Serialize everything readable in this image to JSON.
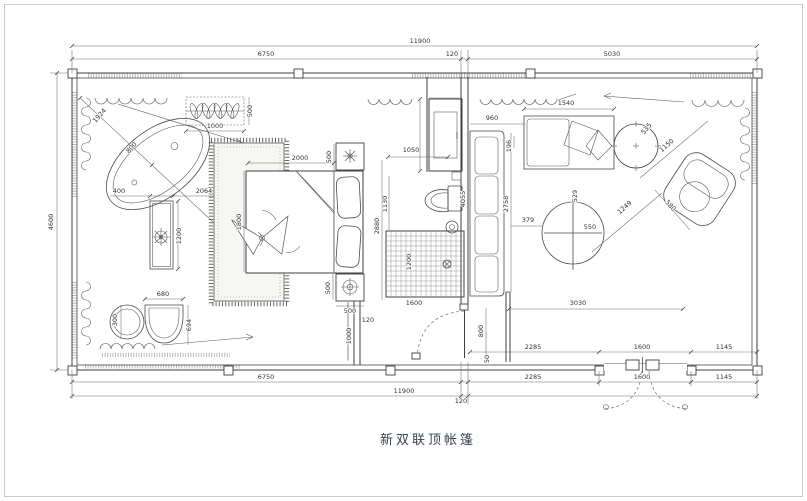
{
  "caption": {
    "text": "新双联顶帐篷"
  },
  "colors": {
    "line": "#3f3f3f",
    "dim_text": "#323232",
    "caption_text": "#39414f",
    "frame_border": "#c9c9c9",
    "background": "#ffffff",
    "shower_grid": "#8a8a8a"
  },
  "elements": {
    "left_zone": [
      "bathtub",
      "plant-rack",
      "vanity-table",
      "round-stool",
      "tub-chair",
      "double-bed",
      "bed-carpet",
      "nightstand-top",
      "nightstand-bottom",
      "curtain-swags",
      "curtain-scrolls"
    ],
    "middle_zone": [
      "wardrobe-cabinet",
      "toilet",
      "floor-drain",
      "shower-grid",
      "interior-door"
    ],
    "right_zone": [
      "long-sofa",
      "chaise-sofa",
      "side-table",
      "armchair",
      "round-table",
      "entry-double-door",
      "curtain-swags",
      "curtain-scrolls"
    ]
  },
  "dims": {
    "d50": "50",
    "d120": "120",
    "d196": "196",
    "d300": "300",
    "d379": "379",
    "d400": "400",
    "d500": "500",
    "d529": "529",
    "d535": "535",
    "d550": "550",
    "d580": "580",
    "d680": "680",
    "d694": "694",
    "d800": "800",
    "d960": "960",
    "d1000": "1000",
    "d1050": "1050",
    "d1130": "1130",
    "d1145": "1145",
    "d1150": "1150",
    "d1200": "1200",
    "d1249": "1249",
    "d1540": "1540",
    "d1600": "1600",
    "d1800": "1800",
    "d1924": "1924",
    "d2000": "2000",
    "d2064": "2064",
    "d2285": "2285",
    "d2758": "2758",
    "d2880": "2880",
    "d3030": "3030",
    "d4055": "4055",
    "d4600": "4600",
    "d5030": "5030",
    "d6750": "6750",
    "d11900": "11900"
  }
}
